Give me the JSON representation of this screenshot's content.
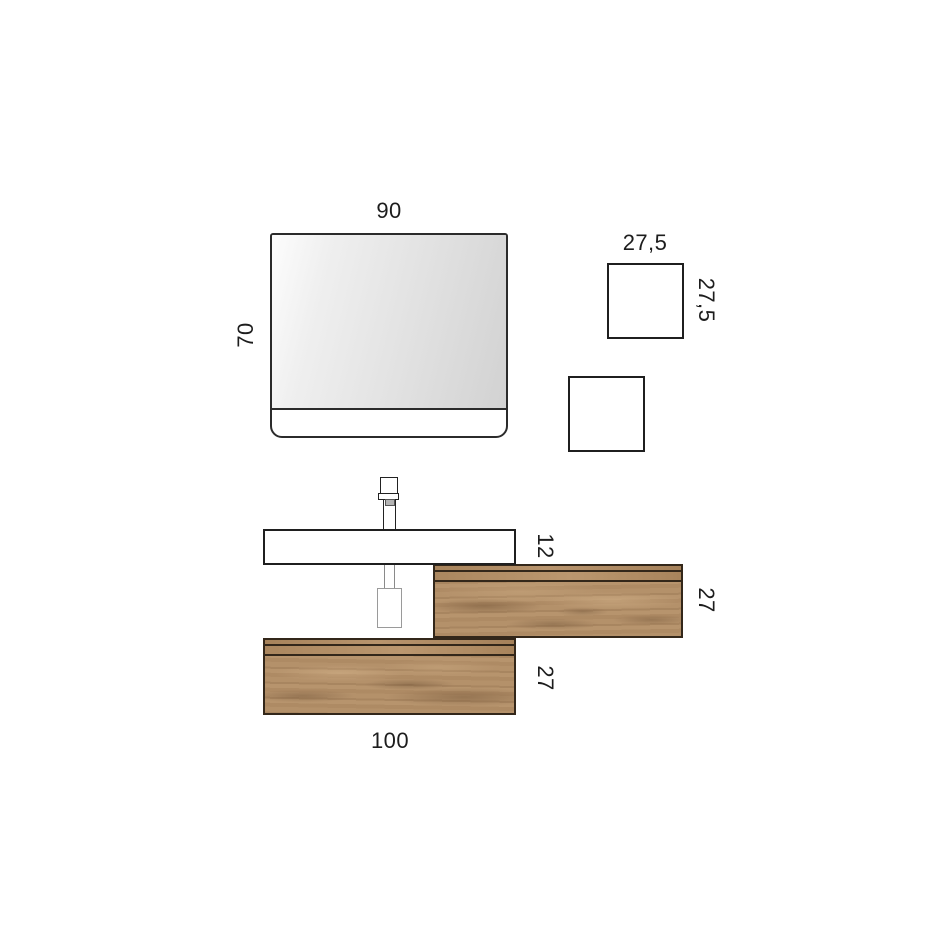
{
  "title": "Bathroom vanity composition - dimensional drawing",
  "colors": {
    "background": "#ffffff",
    "outline": "#1f1f1f",
    "text": "#1d1d1d",
    "wood_base": "#b3906a",
    "wood_groove": "#33271a",
    "siphon_outline": "#9a9a9a",
    "mirror_glass_light": "#fdfdfd",
    "mirror_glass_dark": "#d2d2d2"
  },
  "labels": {
    "mirror_width": "90",
    "mirror_height": "70",
    "upper_square_width": "27,5",
    "upper_square_height": "27,5",
    "basin_height": "12",
    "right_cabinet_height": "27",
    "left_cabinet_height": "27",
    "left_cabinet_width": "100"
  }
}
